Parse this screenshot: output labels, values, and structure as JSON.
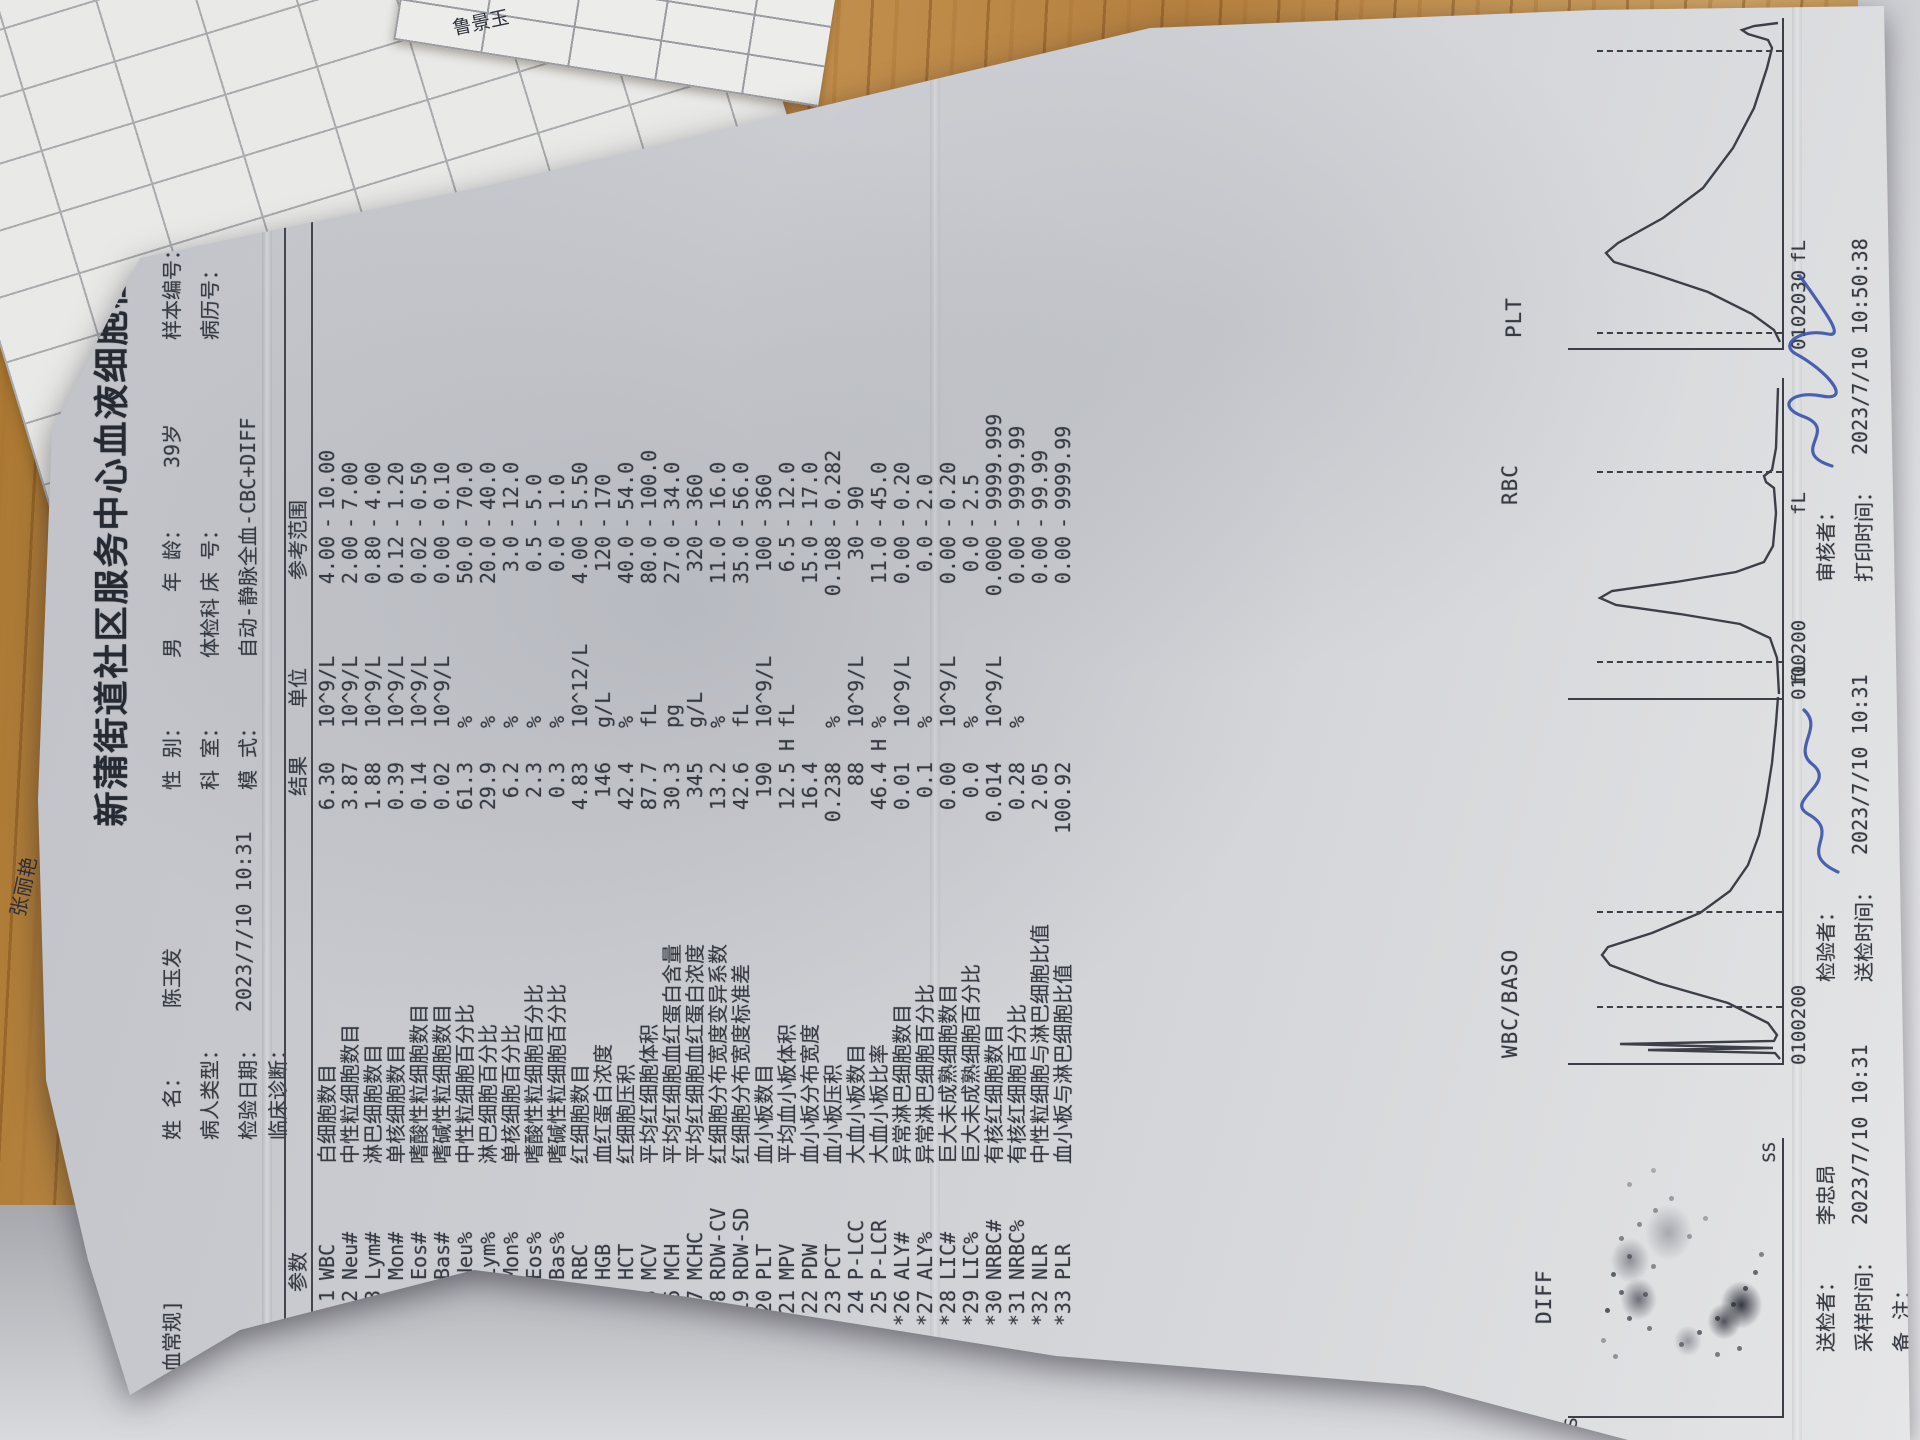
{
  "report": {
    "title": "新蒲街道社区服务中心血液细胞检验报告单",
    "header": {
      "panel_tag": "[血常规]",
      "name_label": "姓  名：",
      "name_value": "陈玉发",
      "sex_label": "性  别：",
      "sex_value": "男",
      "age_label": "年  龄：",
      "age_value": "39岁",
      "sample_no_label": "样本编号：",
      "sample_no_value": "2",
      "patient_type_label": "病人类型：",
      "patient_type_value": "",
      "dept_label": "科  室：",
      "dept_value": "体检科",
      "bed_label": "床  号：",
      "bed_value": "",
      "record_no_label": "病历号：",
      "record_no_value": "",
      "test_date_label": "检验日期：",
      "test_date_value": "2023/7/10  10:31",
      "mode_label": "模  式：",
      "mode_value": "自动-静脉全血-CBC+DIFF",
      "diagnosis_label": "临床诊断："
    },
    "table": {
      "col_param": "参数",
      "col_result": "结果",
      "col_unit": "单位",
      "col_range": "参考范围",
      "rows": [
        {
          "num": "1",
          "code": "WBC",
          "name": "白细胞数目",
          "result": "6.30",
          "flag": "",
          "unit": "10^9/L",
          "lo": "4.00",
          "hi": "10.00"
        },
        {
          "num": "2",
          "code": "Neu#",
          "name": "中性粒细胞数目",
          "result": "3.87",
          "flag": "",
          "unit": "10^9/L",
          "lo": "2.00",
          "hi": "7.00"
        },
        {
          "num": "3",
          "code": "Lym#",
          "name": "淋巴细胞数目",
          "result": "1.88",
          "flag": "",
          "unit": "10^9/L",
          "lo": "0.80",
          "hi": "4.00"
        },
        {
          "num": "4",
          "code": "Mon#",
          "name": "单核细胞数目",
          "result": "0.39",
          "flag": "",
          "unit": "10^9/L",
          "lo": "0.12",
          "hi": "1.20"
        },
        {
          "num": "5",
          "code": "Eos#",
          "name": "嗜酸性粒细胞数目",
          "result": "0.14",
          "flag": "",
          "unit": "10^9/L",
          "lo": "0.02",
          "hi": "0.50"
        },
        {
          "num": "6",
          "code": "Bas#",
          "name": "嗜碱性粒细胞数目",
          "result": "0.02",
          "flag": "",
          "unit": "10^9/L",
          "lo": "0.00",
          "hi": "0.10"
        },
        {
          "num": "7",
          "code": "Neu%",
          "name": "中性粒细胞百分比",
          "result": "61.3",
          "flag": "",
          "unit": "%",
          "lo": "50.0",
          "hi": "70.0"
        },
        {
          "num": "8",
          "code": "Lym%",
          "name": "淋巴细胞百分比",
          "result": "29.9",
          "flag": "",
          "unit": "%",
          "lo": "20.0",
          "hi": "40.0"
        },
        {
          "num": "9",
          "code": "Mon%",
          "name": "单核细胞百分比",
          "result": "6.2",
          "flag": "",
          "unit": "%",
          "lo": "3.0",
          "hi": "12.0"
        },
        {
          "num": "10",
          "code": "Eos%",
          "name": "嗜酸性粒细胞百分比",
          "result": "2.3",
          "flag": "",
          "unit": "%",
          "lo": "0.5",
          "hi": "5.0"
        },
        {
          "num": "11",
          "code": "Bas%",
          "name": "嗜碱性粒细胞百分比",
          "result": "0.3",
          "flag": "",
          "unit": "%",
          "lo": "0.0",
          "hi": "1.0"
        },
        {
          "num": "12",
          "code": "RBC",
          "name": "红细胞数目",
          "result": "4.83",
          "flag": "",
          "unit": "10^12/L",
          "lo": "4.00",
          "hi": "5.50"
        },
        {
          "num": "13",
          "code": "HGB",
          "name": "血红蛋白浓度",
          "result": "146",
          "flag": "",
          "unit": "g/L",
          "lo": "120",
          "hi": "170"
        },
        {
          "num": "14",
          "code": "HCT",
          "name": "红细胞压积",
          "result": "42.4",
          "flag": "",
          "unit": "%",
          "lo": "40.0",
          "hi": "54.0"
        },
        {
          "num": "15",
          "code": "MCV",
          "name": "平均红细胞体积",
          "result": "87.7",
          "flag": "",
          "unit": "fL",
          "lo": "80.0",
          "hi": "100.0"
        },
        {
          "num": "16",
          "code": "MCH",
          "name": "平均红细胞血红蛋白含量",
          "result": "30.3",
          "flag": "",
          "unit": "pg",
          "lo": "27.0",
          "hi": "34.0"
        },
        {
          "num": "17",
          "code": "MCHC",
          "name": "平均红细胞血红蛋白浓度",
          "result": "345",
          "flag": "",
          "unit": "g/L",
          "lo": "320",
          "hi": "360"
        },
        {
          "num": "18",
          "code": "RDW-CV",
          "name": "红细胞分布宽度变异系数",
          "result": "13.2",
          "flag": "",
          "unit": "%",
          "lo": "11.0",
          "hi": "16.0"
        },
        {
          "num": "19",
          "code": "RDW-SD",
          "name": "红细胞分布宽度标准差",
          "result": "42.6",
          "flag": "",
          "unit": "fL",
          "lo": "35.0",
          "hi": "56.0"
        },
        {
          "num": "20",
          "code": "PLT",
          "name": "血小板数目",
          "result": "190",
          "flag": "",
          "unit": "10^9/L",
          "lo": "100",
          "hi": "360"
        },
        {
          "num": "21",
          "code": "MPV",
          "name": "平均血小板体积",
          "result": "12.5",
          "flag": "H",
          "unit": "fL",
          "lo": "6.5",
          "hi": "12.0"
        },
        {
          "num": "22",
          "code": "PDW",
          "name": "血小板分布宽度",
          "result": "16.4",
          "flag": "",
          "unit": "",
          "lo": "15.0",
          "hi": "17.0"
        },
        {
          "num": "23",
          "code": "PCT",
          "name": "血小板压积",
          "result": "0.238",
          "flag": "",
          "unit": "%",
          "lo": "0.108",
          "hi": "0.282"
        },
        {
          "num": "24",
          "code": "P-LCC",
          "name": "大血小板数目",
          "result": "88",
          "flag": "",
          "unit": "10^9/L",
          "lo": "30",
          "hi": "90"
        },
        {
          "num": "25",
          "code": "P-LCR",
          "name": "大血小板比率",
          "result": "46.4",
          "flag": "H",
          "unit": "%",
          "lo": "11.0",
          "hi": "45.0"
        },
        {
          "num": "*26",
          "code": "ALY#",
          "name": "异常淋巴细胞数目",
          "result": "0.01",
          "flag": "",
          "unit": "10^9/L",
          "lo": "0.00",
          "hi": "0.20"
        },
        {
          "num": "*27",
          "code": "ALY%",
          "name": "异常淋巴细胞百分比",
          "result": "0.1",
          "flag": "",
          "unit": "%",
          "lo": "0.0",
          "hi": "2.0"
        },
        {
          "num": "*28",
          "code": "LIC#",
          "name": "巨大未成熟细胞数目",
          "result": "0.00",
          "flag": "",
          "unit": "10^9/L",
          "lo": "0.00",
          "hi": "0.20"
        },
        {
          "num": "*29",
          "code": "LIC%",
          "name": "巨大未成熟细胞百分比",
          "result": "0.0",
          "flag": "",
          "unit": "%",
          "lo": "0.0",
          "hi": "2.5"
        },
        {
          "num": "*30",
          "code": "NRBC#",
          "name": "有核红细胞数目",
          "result": "0.014",
          "flag": "",
          "unit": "10^9/L",
          "lo": "0.000",
          "hi": "9999.999"
        },
        {
          "num": "*31",
          "code": "NRBC%",
          "name": "有核红细胞百分比",
          "result": "0.28",
          "flag": "",
          "unit": "%",
          "lo": "0.00",
          "hi": "9999.99"
        },
        {
          "num": "*32",
          "code": "NLR",
          "name": "中性粒细胞与淋巴细胞比值",
          "result": "2.05",
          "flag": "",
          "unit": "",
          "lo": "0.00",
          "hi": "99.99"
        },
        {
          "num": "*33",
          "code": "PLR",
          "name": "血小板与淋巴细胞比值",
          "result": "100.92",
          "flag": "",
          "unit": "",
          "lo": "0.00",
          "hi": "9999.99"
        }
      ]
    },
    "charts": {
      "diff": {
        "title": "DIFF",
        "y_label": "FS",
        "x_label": "SS"
      },
      "wbc": {
        "title": "WBC/BASO",
        "ticks": [
          "0",
          "100",
          "200"
        ],
        "unit": "fL"
      },
      "rbc": {
        "title": "RBC",
        "ticks": [
          "0",
          "100",
          "200"
        ],
        "unit": "fL"
      },
      "plt": {
        "title": "PLT",
        "ticks": [
          "0",
          "10",
          "20",
          "30"
        ],
        "unit": "fL"
      }
    },
    "footer": {
      "sender_label": "送检者：",
      "sender_value": "李忠昂",
      "tester_label": "检验者：",
      "reviewer_label": "审核者：",
      "sample_time_label": "采样时间：",
      "sample_time_value": "2023/7/10  10:31",
      "send_time_label": "送检时间：",
      "send_time_value": "2023/7/10  10:31",
      "print_time_label": "打印时间：",
      "print_time_value": "2023/7/10  10:50:38",
      "note_label": "备  注：",
      "disclaimer": "【本结果仅对此次检测标本负责】"
    }
  },
  "background": {
    "promo_text": "日化促销员",
    "handwritten_name_1": "张丽艳",
    "handwritten_name_2": "鲁景玉"
  }
}
